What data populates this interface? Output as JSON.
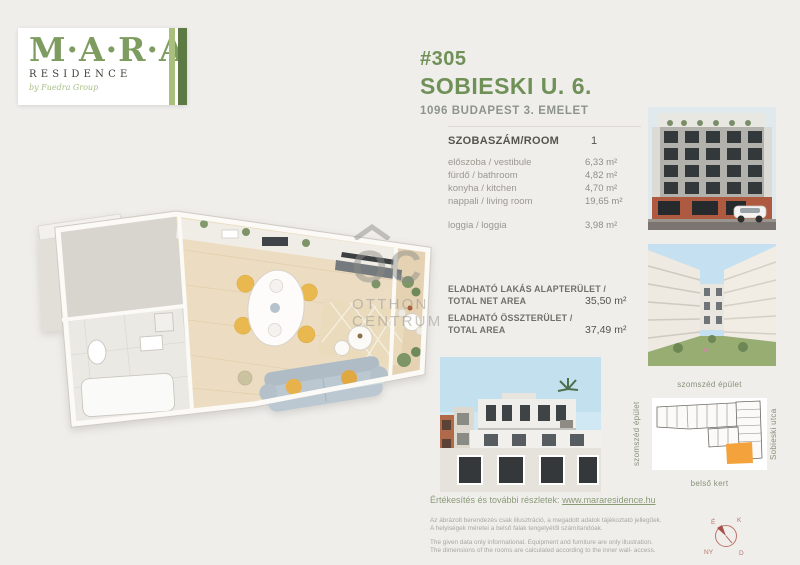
{
  "logo": {
    "brand": "M·A·R·A",
    "residence": "RESIDENCE",
    "tagline": "by Fuedra Group"
  },
  "header": {
    "unit_number": "#305",
    "street": "SOBIESKI U. 6.",
    "city_line": "1096  BUDAPEST 3. EMELET"
  },
  "room_table": {
    "header_label": "SZOBASZÁM/ROOM",
    "header_value": "1",
    "rows": [
      {
        "label": "előszoba / vestibule",
        "value": "6,33 m²"
      },
      {
        "label": "fürdő / bathroom",
        "value": "4,82 m²"
      },
      {
        "label": "konyha / kitchen",
        "value": "4,70 m²"
      },
      {
        "label": "nappali / living room",
        "value": "19,65 m²"
      }
    ],
    "loggia_row": {
      "label": "loggia / loggia",
      "value": "3,98 m²"
    }
  },
  "totals": {
    "net": {
      "label_hu": "ELADHATÓ LAKÁS ALAPTERÜLET /",
      "label_en": "TOTAL  NET AREA",
      "value": "35,50 m²"
    },
    "total": {
      "label_hu": "ELADHATÓ ÖSSZTERÜLET /",
      "label_en": "TOTAL AREA",
      "value": "37,49 m²"
    }
  },
  "locator": {
    "top_label": "szomszéd épület",
    "left_label": "szomszéd épület",
    "right_label": "Sobieski utca",
    "bottom_label": "belső kert"
  },
  "footer": {
    "sales_text": "Értékesítés és további részletek: ",
    "link": "www.mararesidence.hu",
    "disclaimer_hu_1": "Az ábrázolt berendezés csak illusztráció, a megadott adatok tájékoztató jellegűek.",
    "disclaimer_hu_2": "A helyiségek méretei a belső falak tengelyétől számítandóak.",
    "disclaimer_en_1": "The given data only informational. Equipment and furniture are only illustration.",
    "disclaimer_en_2": "The dimensions of the rooms are calculated according to the inner wall- access."
  },
  "watermark": {
    "mark": "OC",
    "line1": "OTTHON",
    "line2": "CENTRUM"
  },
  "compass": {
    "n": "É",
    "e": "K",
    "w": "NY",
    "s": "D"
  },
  "colors": {
    "accent_green": "#6f9158",
    "logo_green": "#7e9c60",
    "stripe_light_green": "#a9bf7d",
    "stripe_dark_green": "#5d7a45",
    "background": "#f0eeeb",
    "highlight_orange": "#f4a33c",
    "compass_red": "#bd746b"
  }
}
